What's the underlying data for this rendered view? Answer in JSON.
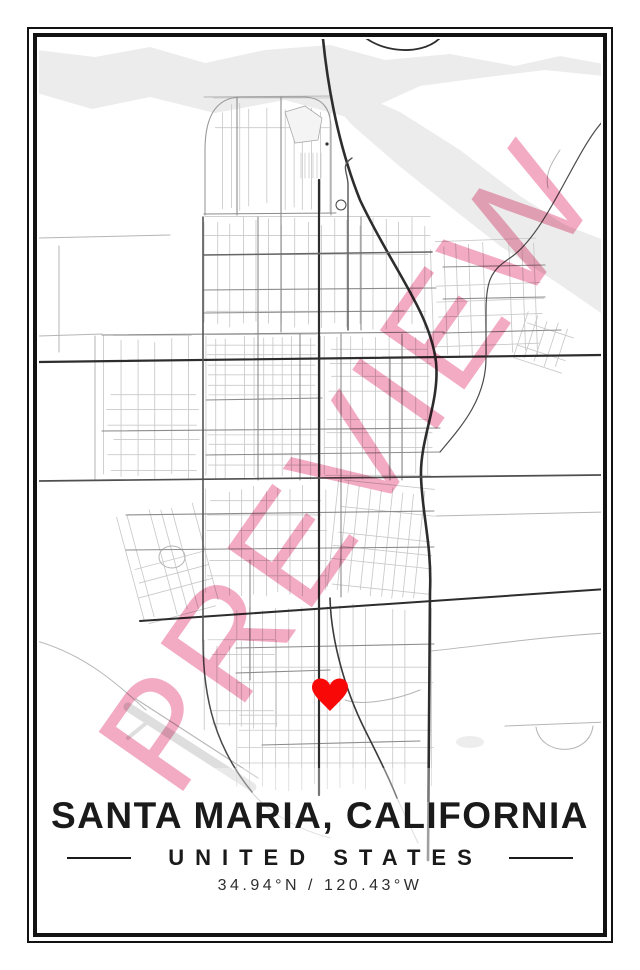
{
  "poster": {
    "watermark_text": "PREVIEW",
    "title": "SANTA MARIA, CALIFORNIA",
    "subtitle": "UNITED STATES",
    "coordinates": "34.94°N / 120.43°W",
    "marker": {
      "name": "heart",
      "color": "#f90808"
    },
    "colors": {
      "watermark_pink": "#f2abc2",
      "frame_black": "#121212",
      "land_white": "#ffffff",
      "water_gray": "#ececec",
      "road_light": "#c9c9c9",
      "road_medium": "#8c8c8c",
      "road_dark": "#2d2d2d",
      "text_black": "#1a1a1a"
    }
  }
}
